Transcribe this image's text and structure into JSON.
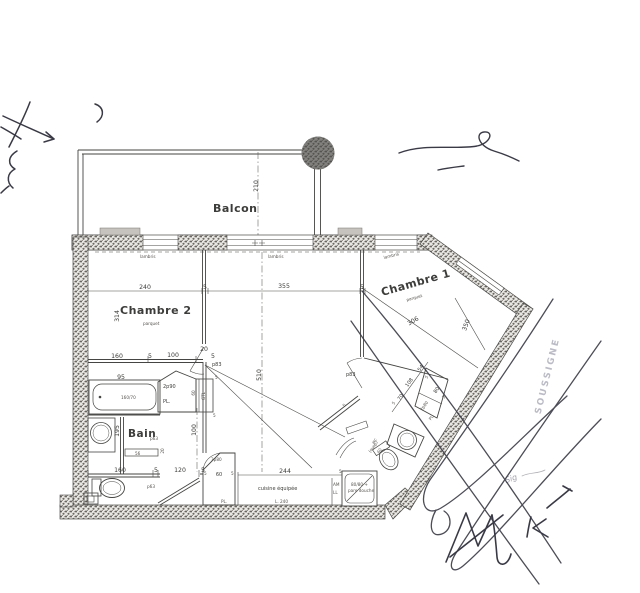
{
  "rooms": {
    "balcony": "Balcon",
    "chambre2": "Chambre 2",
    "chambre2_floor": "parquet",
    "chambre1": "Chambre 1",
    "chambre1_floor": "parquet",
    "bath": "Bain",
    "kitchen": "cuisine équipée",
    "kitchen_len": "L. 240",
    "wc_l1": "wc",
    "wc_l2": "(susp)"
  },
  "finishes": {
    "lambris_a": "lambris",
    "lambris_b": "lambris",
    "lambris_c": "lambris"
  },
  "dims": {
    "balcony_depth": "210",
    "ch2_width": "240",
    "sep1": "5",
    "living_width": "355",
    "sep2": "5",
    "ch2_depth": "314",
    "living_depth": "510",
    "row_160": "160",
    "row_5a": "5",
    "row_100": "100",
    "row_20": "20",
    "row_5b": "5",
    "bath_95": "95",
    "bath_195": "195",
    "hall_100": "100",
    "shelf_56": "56",
    "shelf_20": "20",
    "gtl_60": "60",
    "gtl_5a": "5",
    "gtl_5b": "5",
    "wc_160": "160",
    "wc_5a": "5",
    "wc_120": "120",
    "wc_5b": "5",
    "kitchen_244": "244",
    "kitchen_5": "5",
    "closet_60": "60",
    "closet_5a": "5",
    "closet_5b": "5",
    "corr_70": "70",
    "corr_108": "108",
    "corr_54": "54",
    "corr_5a": "5",
    "entry_80": "80",
    "entry_5a": "5",
    "entry_5b": "5",
    "ch1_306": "306",
    "ch1_350": "350",
    "wc_60": "60"
  },
  "doors": {
    "p83_a": "p83",
    "p83_b": "p83",
    "p63_a": "p63",
    "p63_b": "p63"
  },
  "fixtures": {
    "tub": "160/70",
    "shower_l1": "80/80 +",
    "shower_l2": "pare douche",
    "closet_2p90": "2p90",
    "closet_3p80": "3p80",
    "closet_2p80": "2p80",
    "pl_a": "PL.",
    "pl_b": "PL.",
    "pl_c": "PL",
    "gtl": "GTL",
    "am": "AM",
    "ll": "LL"
  },
  "annotations": {
    "stamp": "SOUSSIGNE",
    "sig": "Sig"
  },
  "colors": {
    "ink": "#3c3c3a",
    "wall_speckle": "#5f5b56",
    "pen_ink": "#3a3a46",
    "paper": "#ffffff"
  }
}
